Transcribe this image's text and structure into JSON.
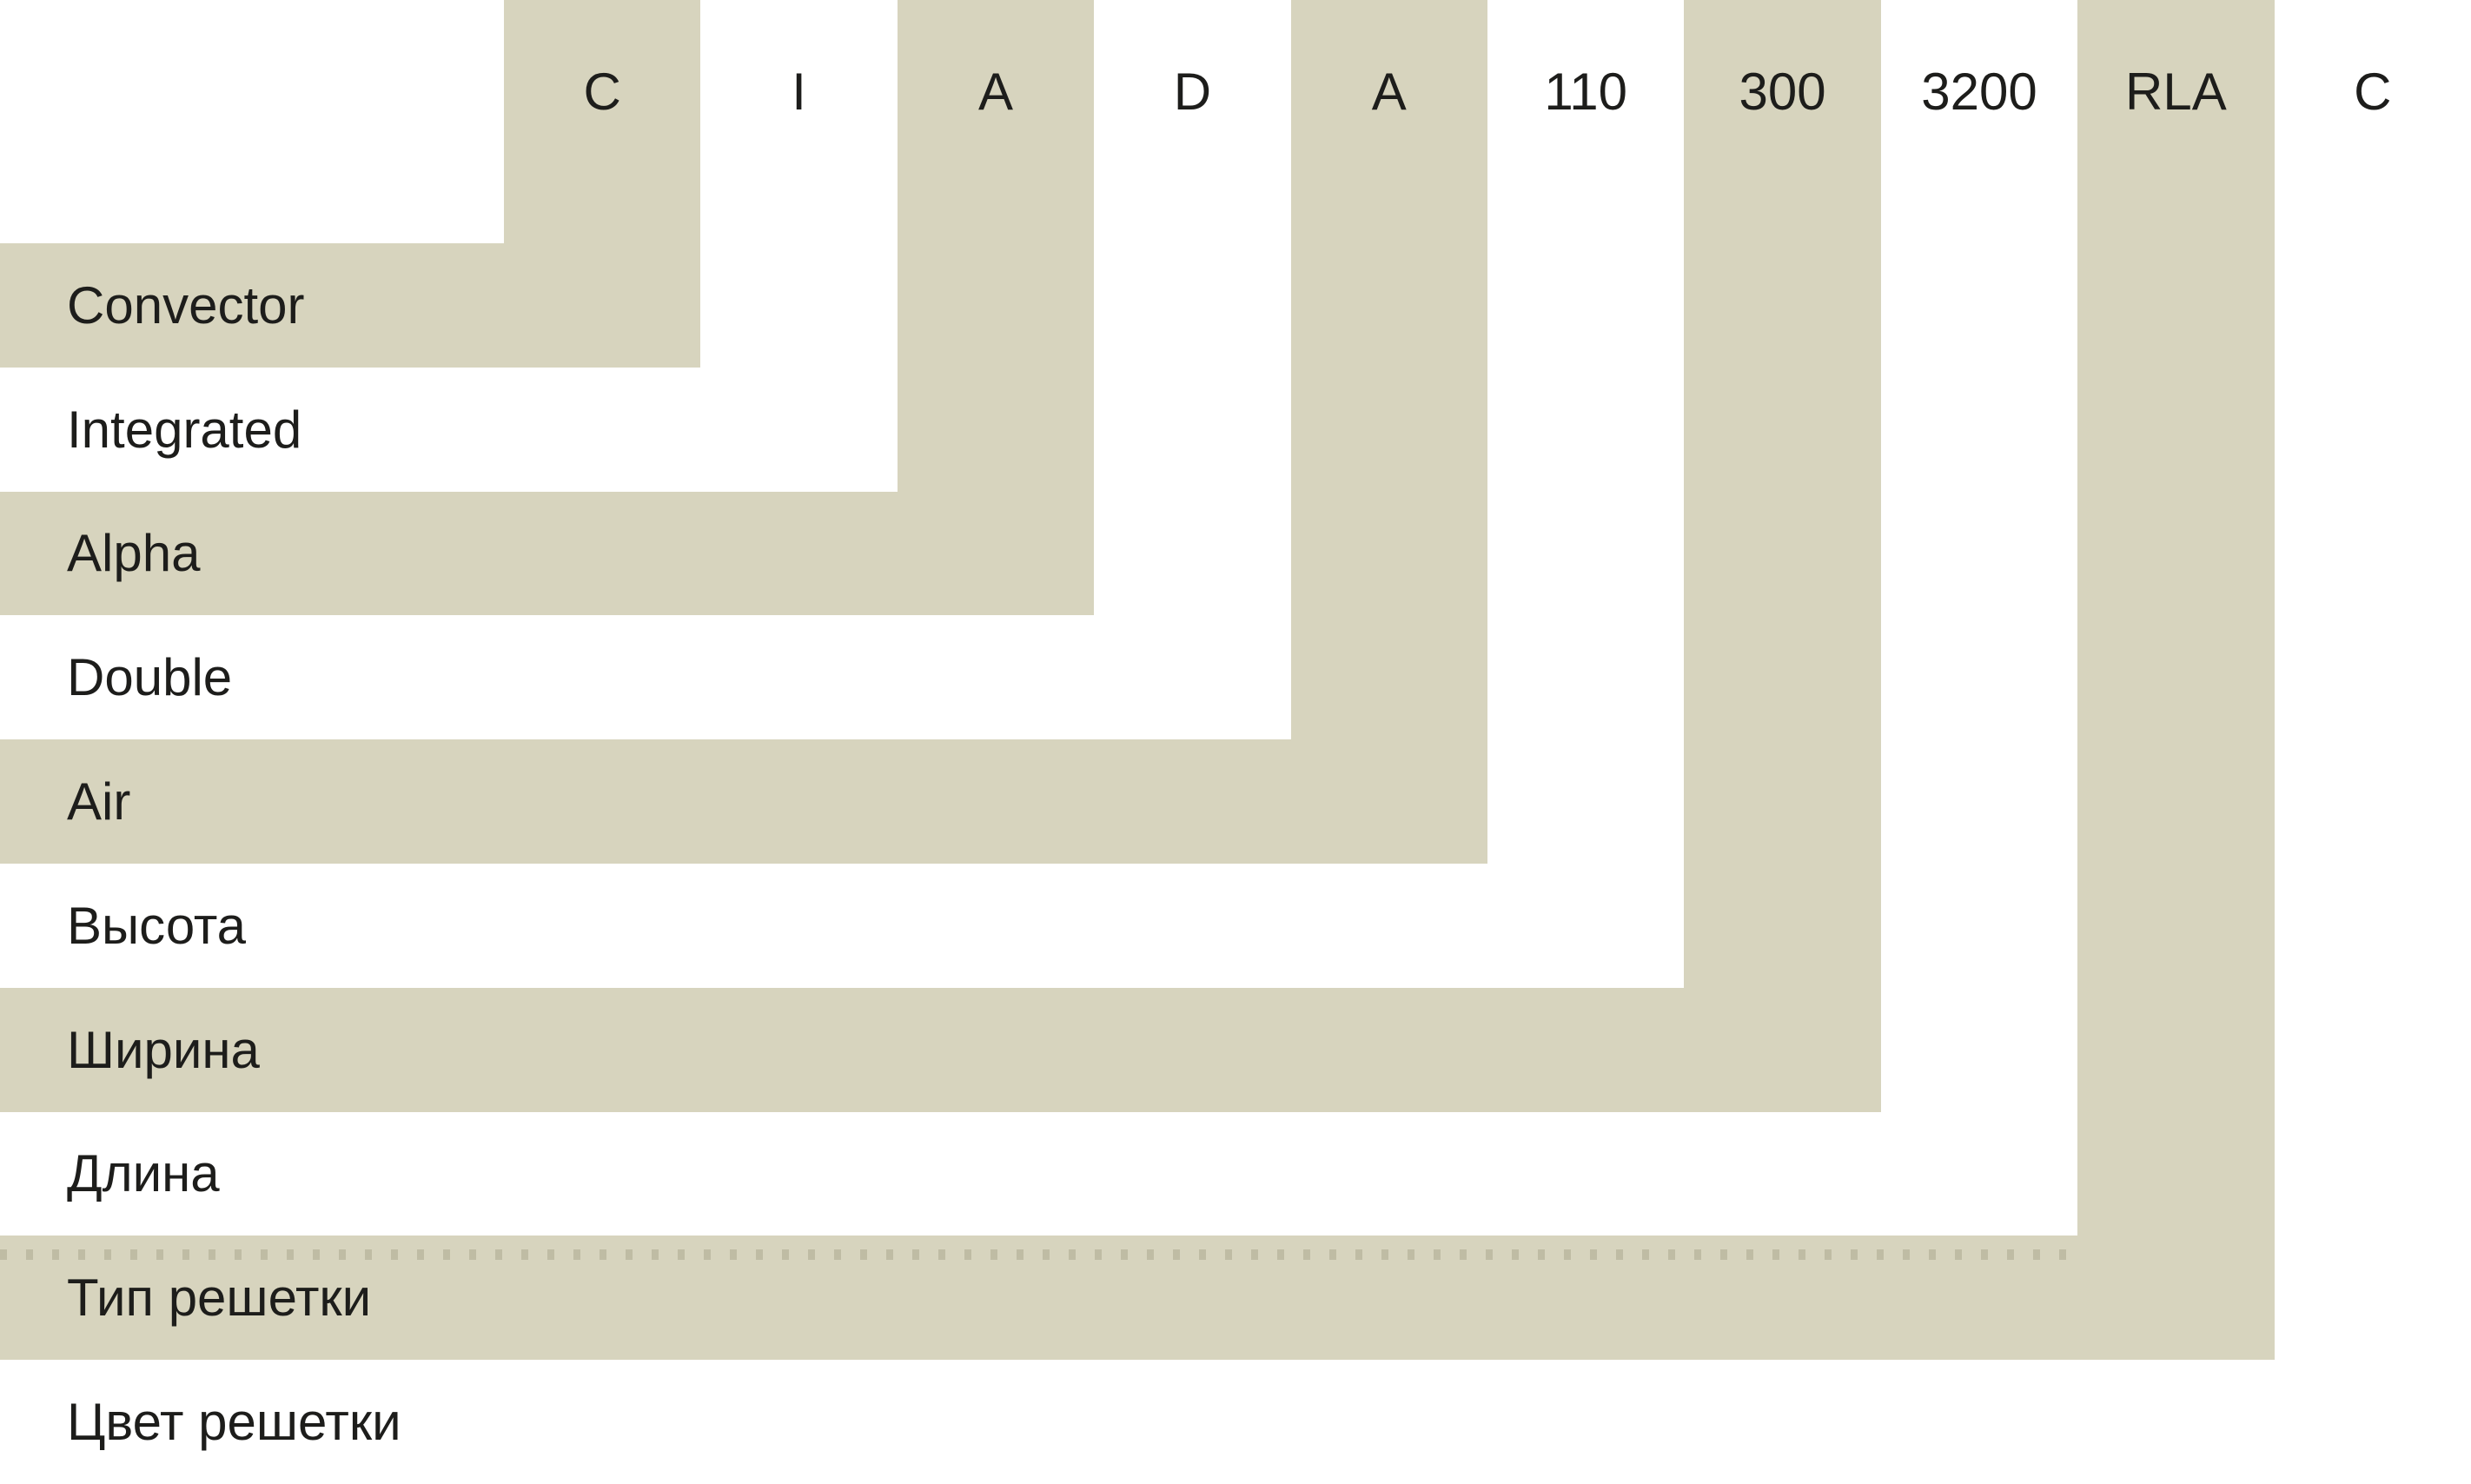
{
  "diagram_title": "Product code nomenclature",
  "product_code": [
    "C",
    "I",
    "A",
    "D",
    "A",
    "110",
    "300",
    "3200",
    "RLA",
    "C"
  ],
  "segments": [
    {
      "code": "C",
      "label": "Convector",
      "band": "beige",
      "dotted_line": false
    },
    {
      "code": "I",
      "label": "Integrated",
      "band": "white",
      "dotted_line": false
    },
    {
      "code": "A",
      "label": "Alpha",
      "band": "beige",
      "dotted_line": false
    },
    {
      "code": "D",
      "label": "Double",
      "band": "white",
      "dotted_line": false
    },
    {
      "code": "A",
      "label": "Air",
      "band": "beige",
      "dotted_line": false
    },
    {
      "code": "110",
      "label": "Высота",
      "band": "white",
      "dotted_line": false
    },
    {
      "code": "300",
      "label": "Ширина",
      "band": "beige",
      "dotted_line": false
    },
    {
      "code": "3200",
      "label": "Длина",
      "band": "white",
      "dotted_line": false
    },
    {
      "code": "RLA",
      "label": "Тип решетки",
      "band": "beige",
      "dotted_line": true
    },
    {
      "code": "C",
      "label": "Цвет решетки",
      "band": "white",
      "dotted_line": false
    }
  ],
  "colors": {
    "band_fill": "#d7d4be",
    "background": "#ffffff",
    "text": "#1d1d1b",
    "dotted_line": "#bfbca4"
  }
}
